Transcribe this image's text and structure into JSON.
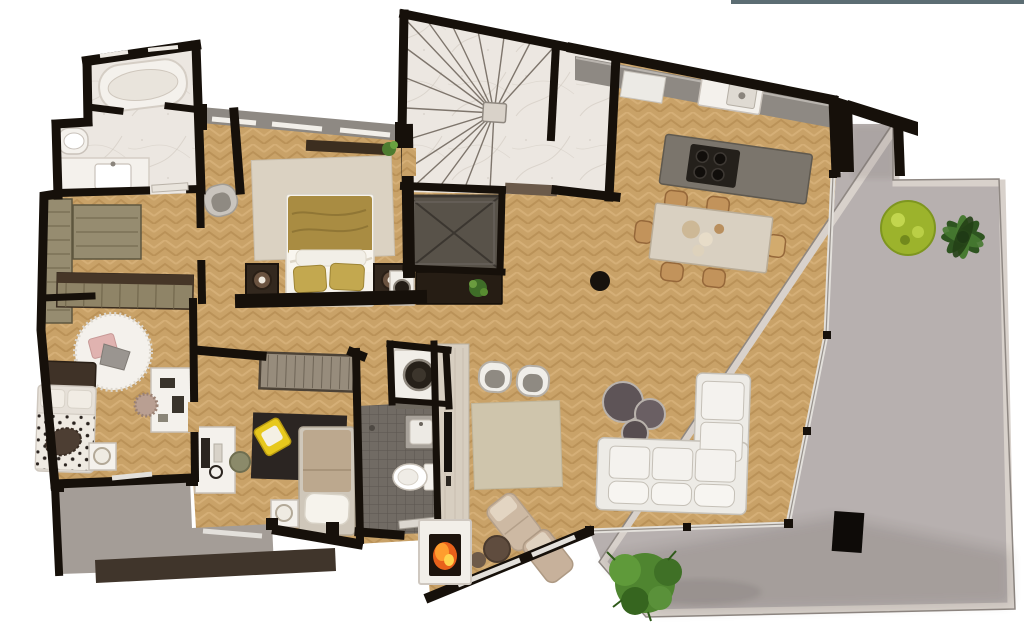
{
  "page": {
    "background": "#ffffff",
    "top_edge_artifact": {
      "color": "#5c6d73",
      "description": "partial gray toolbar edge line at top-right of screenshot"
    }
  },
  "floorplan": {
    "type": "residential apartment penthouse, top-down 3D rendered plan, no text labels",
    "rooms": [
      {
        "id": "master-bathroom",
        "label": "master bathroom",
        "floor": "white marble",
        "furniture": [
          "oval bathtub",
          "wall toilet",
          "vanity with sink"
        ]
      },
      {
        "id": "dressing-room",
        "label": "dressing room",
        "floor": "herringbone wood",
        "furniture": [
          "wardrobe unit left",
          "wardrobe unit center",
          "wardrobe band"
        ]
      },
      {
        "id": "master-bedroom",
        "label": "master bedroom",
        "floor": "herringbone wood",
        "furniture": [
          "double bed with gold duvet",
          "two dark nightstands with round lamps",
          "beige area rug",
          "gray tub chair",
          "wall shelf",
          "potted plant"
        ]
      },
      {
        "id": "staircase",
        "label": "winder staircase",
        "floor": "marble terrazzo",
        "furniture": [
          "center newel post",
          "radial steps"
        ]
      },
      {
        "id": "elevator",
        "label": "elevator shaft",
        "floor": "dark gray with X brace",
        "furniture": []
      },
      {
        "id": "kitchen",
        "label": "kitchen",
        "floor": "herringbone wood",
        "furniture": [
          "wall counter",
          "sink with faucet",
          "island with 4-burner cooktop"
        ]
      },
      {
        "id": "dining-area",
        "label": "dining area",
        "floor": "herringbone wood",
        "furniture": [
          "stone dining table",
          "six tan chairs",
          "tableware"
        ]
      },
      {
        "id": "living-room",
        "label": "living room",
        "floor": "herringbone wood",
        "furniture": [
          "L-shaped white sofa",
          "three round coffee tables",
          "two shell armchairs",
          "beige rug",
          "black stool",
          "two lounge chaises",
          "round pouf",
          "sideboard with speaker and plant"
        ]
      },
      {
        "id": "media-wall",
        "label": "media wall",
        "furniture": [
          "wood TV panel",
          "flat TV",
          "fireplace with fire"
        ]
      },
      {
        "id": "bedroom-2",
        "label": "bedroom 2",
        "floor": "herringbone wood",
        "furniture": [
          "bed with spotted duvet",
          "round fluffy rug with cushions",
          "white desk",
          "fluffy chair",
          "nightstand with lamp",
          "wardrobe band"
        ]
      },
      {
        "id": "bedroom-3",
        "label": "bedroom 3",
        "floor": "herringbone wood",
        "furniture": [
          "single bed",
          "white desk with monitor and headphones",
          "dark rug",
          "yellow lounge chair",
          "olive chair",
          "nightstand with lamp",
          "sliding-door closet"
        ]
      },
      {
        "id": "shower-bathroom",
        "label": "shower bathroom",
        "floor": "dark mosaic tile",
        "furniture": [
          "wall sink",
          "toilet",
          "door leaf"
        ]
      },
      {
        "id": "laundry-nook",
        "label": "laundry nook",
        "furniture": [
          "washing machine"
        ]
      },
      {
        "id": "terrace",
        "label": "terrace",
        "floor": "gray concrete with parapet",
        "furniture": [
          "bright green bush",
          "dark palm plant",
          "black pillar",
          "large bush at bottom"
        ]
      },
      {
        "id": "balcony",
        "label": "balcony strip",
        "floor": "gray concrete",
        "furniture": []
      }
    ],
    "counts": {
      "stair_steps": 16,
      "dining_chairs": 6,
      "cooktop_burners": 4,
      "coffee_tables": 3,
      "terrace_plants_top": 2,
      "terrace_plants_bottom": 1,
      "bedrooms": 3,
      "bathrooms": 2
    }
  },
  "colors": {
    "wall": "#16100a",
    "white": "#ffffff",
    "wood": "#c9a268",
    "woodDark": "#a87e44",
    "woodLight": "#ddba82",
    "marble": "#ece7e1",
    "marbleVein": "#c9c1b7",
    "stairLine": "#6b6258",
    "terrace": "#b7b0af",
    "terraceEdge": "#d8d1cb",
    "terraceLine": "#8f8883",
    "shadow": "#4f463f",
    "balcony": "#a49d97",
    "balconyBand": "#40352b",
    "tile": "#716b64",
    "tileLine": "#5c564f",
    "fixture": "#f4f1ec",
    "fixtureLine": "#c9c2ba",
    "counter": "#8e8983",
    "island": "#7b756c",
    "cooktop": "#24201b",
    "sofa": "#edebe6",
    "sofaLine": "#c5c0b7",
    "cushion": "#8f8a82",
    "coffee": "#5e5457",
    "coffeeRim": "#b9b2ac",
    "tableTop": "#d9d0c1",
    "chairTan": "#c2935b",
    "chairTanLine": "#96683a",
    "rugLiving": "#cfc5ac",
    "rugMaster": "#dbd2c2",
    "rugDark": "#2b2522",
    "rugRound": "#f4f1ec",
    "duvet": "#a98c42",
    "duvetLine": "#8a7132",
    "pillowGold": "#c3a84f",
    "sheet": "#f6f3ec",
    "headboard": "#3f3227",
    "wardrobeDark": "#463627",
    "closetKhaki": "#968c70",
    "closetLine": "#6f654a",
    "tvWall": "#d7cec0",
    "screen": "#15110d",
    "fireOuter": "#e8611b",
    "fireMid": "#ff9d2e",
    "fireInner": "#ffd34d",
    "bushBright": "#9cb32c",
    "palm": "#2e5420",
    "palmLight": "#477a31",
    "bush": "#4f8530",
    "elevator": "#585249",
    "elevatorLine": "#3b3630",
    "glass": "#e3e0db",
    "glassLine": "#97918b",
    "yellow": "#e7c81d",
    "spot": "#2a231f",
    "pink": "#e0b3b0",
    "washerDrum": "#262019",
    "threshold": "#6b5a4a",
    "topline": "#5c6d73",
    "darkFurn": "#33281e",
    "cabinet": "#261d14",
    "chairOlive": "#8b8a6a",
    "chairFluff": "#b99f92"
  }
}
